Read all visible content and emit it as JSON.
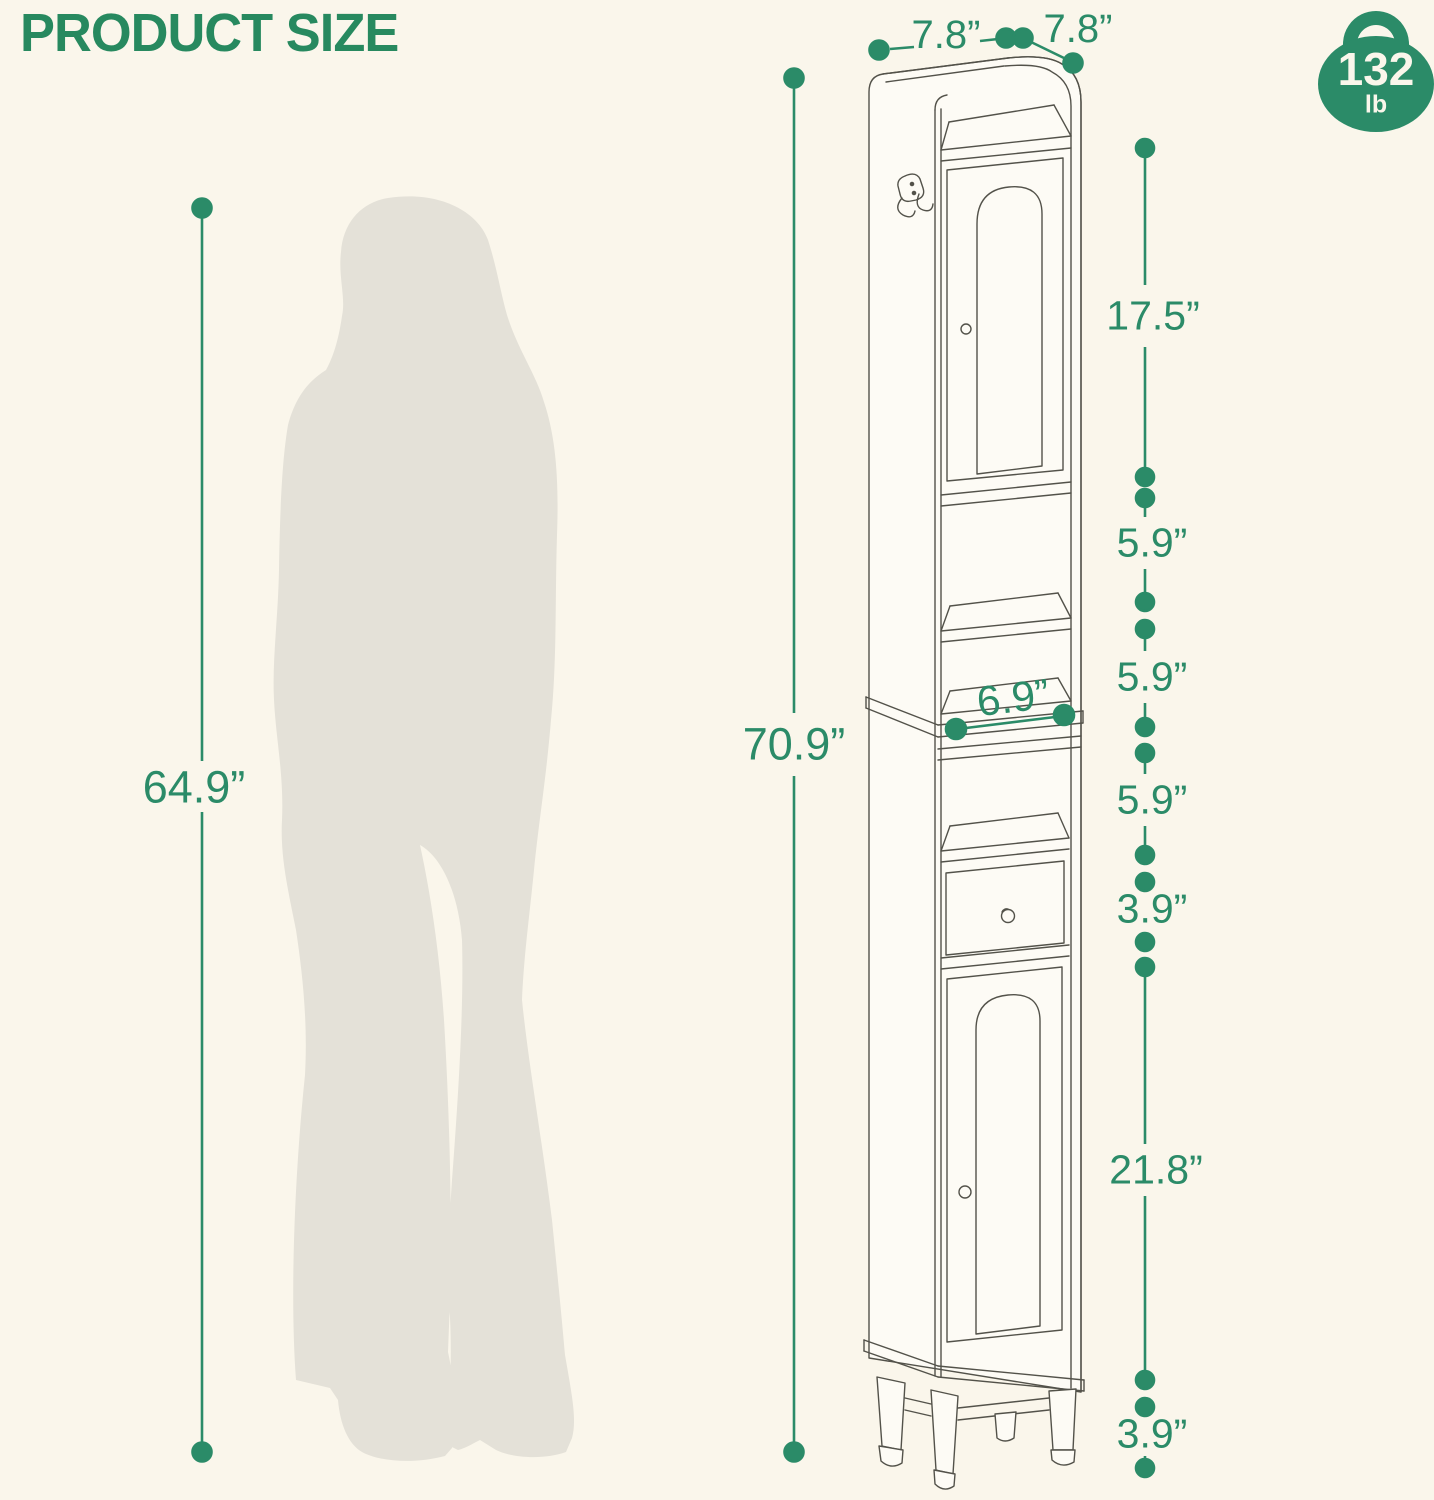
{
  "title": "PRODUCT SIZE",
  "weight_capacity": {
    "value": "132",
    "unit": "lb"
  },
  "labels": {
    "person_height": "64.9”",
    "overall_height": "70.9”",
    "top_depth": "7.8”",
    "top_width": "7.8”",
    "inner_width": "6.9”",
    "upper_door": "17.5”",
    "open_shelf_1": "5.9”",
    "open_shelf_2": "5.9”",
    "open_shelf_3": "5.9”",
    "drawer": "3.9”",
    "lower_door": "21.8”",
    "legs": "3.9”"
  },
  "colors": {
    "accent_green": "#2B8B68",
    "background": "#FAF6EB",
    "silhouette_gray": "#E4E1D8",
    "drawing_line": "#53524A"
  },
  "icons": {
    "weight_badge": "kettlebell-icon",
    "side_hook": "double-hook-icon"
  }
}
